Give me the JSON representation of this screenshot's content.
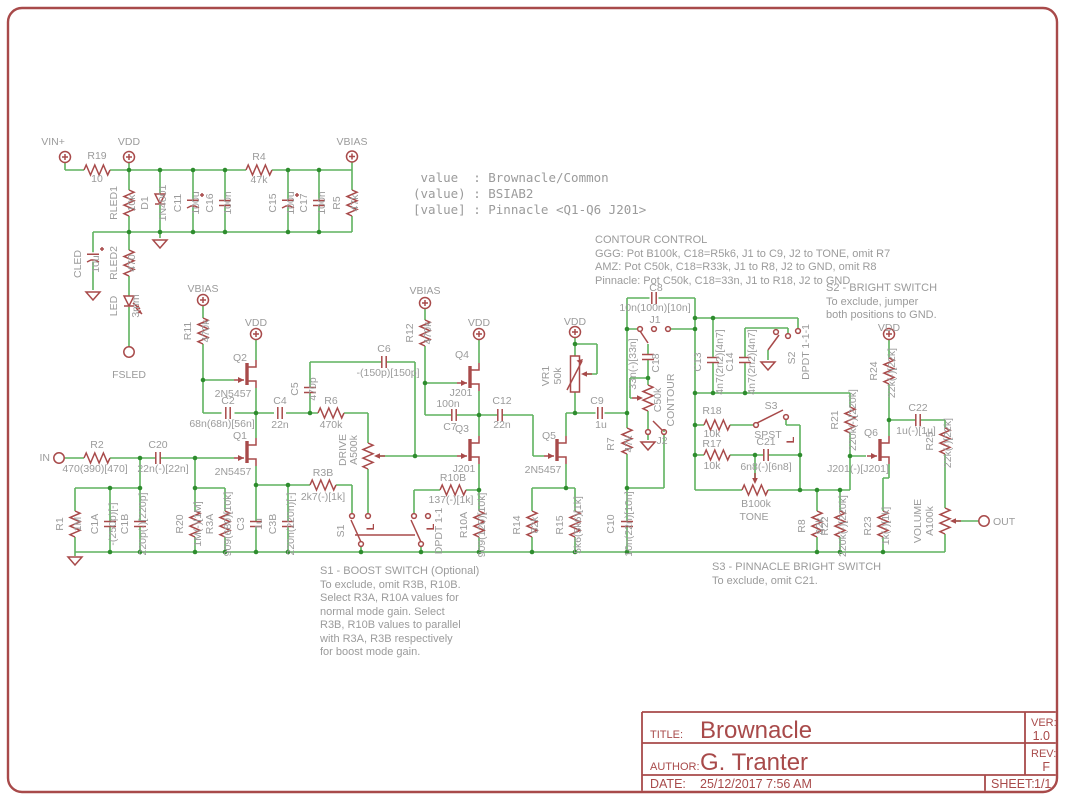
{
  "page": {
    "bg": "#ffffff",
    "frame_color": "#a84a4a",
    "wire_color": "#5fb25f",
    "junction_color": "#2e8c2e",
    "symbol_color": "#a84a4a",
    "label_color": "#9b9b9b"
  },
  "value_block": {
    "lines": [
      " value  : Brownacle/Common",
      "(value) : BSIAB2",
      "[value] : Pinnacle <Q1-Q6 J201>"
    ]
  },
  "notes": {
    "contour": {
      "lines": [
        "CONTOUR CONTROL",
        "GGG: Pot B100k, C18=R5k6, J1 to C9, J2 to TONE, omit R7",
        "AMZ: Pot C50k, C18=R33k, J1 to R8, J2 to GND, omit R8",
        "Pinnacle: Pot C50k, C18=33n, J1 to R18, J2 to GND"
      ]
    },
    "s2": {
      "lines": [
        "S2 - BRIGHT SWITCH",
        "To exclude, jumper",
        "both positions to GND."
      ]
    },
    "s1": {
      "lines": [
        "S1 - BOOST SWITCH (Optional)",
        "To exclude, omit R3B, R10B.",
        "Select R3A, R10A values for",
        "normal mode gain. Select",
        "R3B, R10B values to parallel",
        "with R3A, R3B respectively",
        "for boost mode gain."
      ]
    },
    "s3": {
      "lines": [
        "S3 - PINNACLE BRIGHT SWITCH",
        "To exclude, omit C21."
      ]
    }
  },
  "title_block": {
    "title_label": "TITLE:",
    "title": "Brownacle",
    "author_label": "AUTHOR:",
    "author": "G. Tranter",
    "date_label": "DATE:",
    "date": "25/12/2017 7:56 AM",
    "ver_label": "VER:",
    "ver": "1.0",
    "rev_label": "REV:",
    "rev": "F",
    "sheet_label": "SHEET:",
    "sheet": "1/1"
  },
  "labels": [
    {
      "t": "VIN+",
      "x": 53,
      "y": 145
    },
    {
      "t": "R19",
      "x": 97,
      "y": 159
    },
    {
      "t": "10",
      "x": 97,
      "y": 182
    },
    {
      "t": "VDD",
      "x": 129,
      "y": 145
    },
    {
      "t": "VBIAS",
      "x": 352,
      "y": 145
    },
    {
      "t": "RLED1",
      "x": 117,
      "y": 203,
      "r": 1
    },
    {
      "t": "10k",
      "x": 135,
      "y": 203,
      "r": 1
    },
    {
      "t": "D1",
      "x": 148,
      "y": 203,
      "r": 1
    },
    {
      "t": "1N4001",
      "x": 166,
      "y": 203,
      "r": 1
    },
    {
      "t": "C11",
      "x": 181,
      "y": 203,
      "r": 1
    },
    {
      "t": "100u",
      "x": 199,
      "y": 203,
      "r": 1
    },
    {
      "t": "C16",
      "x": 213,
      "y": 203,
      "r": 1
    },
    {
      "t": "100n",
      "x": 231,
      "y": 203,
      "r": 1
    },
    {
      "t": "R4",
      "x": 259,
      "y": 160
    },
    {
      "t": "47k",
      "x": 259,
      "y": 183
    },
    {
      "t": "C15",
      "x": 276,
      "y": 203,
      "r": 1
    },
    {
      "t": "100u",
      "x": 294,
      "y": 203,
      "r": 1
    },
    {
      "t": "C17",
      "x": 307,
      "y": 203,
      "r": 1
    },
    {
      "t": "100n",
      "x": 325,
      "y": 203,
      "r": 1
    },
    {
      "t": "R5",
      "x": 340,
      "y": 203,
      "r": 1
    },
    {
      "t": "47k",
      "x": 358,
      "y": 203,
      "r": 1
    },
    {
      "t": "CLED",
      "x": 81,
      "y": 264,
      "r": 1
    },
    {
      "t": "10u",
      "x": 99,
      "y": 264,
      "r": 1
    },
    {
      "t": "RLED2",
      "x": 117,
      "y": 263,
      "r": 1
    },
    {
      "t": "470",
      "x": 135,
      "y": 263,
      "r": 1
    },
    {
      "t": "LED",
      "x": 117,
      "y": 306,
      "r": 1
    },
    {
      "t": "3mm",
      "x": 139,
      "y": 306,
      "r": 1
    },
    {
      "t": "FSLED",
      "x": 129,
      "y": 378
    },
    {
      "t": "VBIAS",
      "x": 203,
      "y": 292
    },
    {
      "t": "R11",
      "x": 191,
      "y": 331,
      "r": 1
    },
    {
      "t": "470k",
      "x": 209,
      "y": 331,
      "r": 1
    },
    {
      "t": "VDD",
      "x": 256,
      "y": 326
    },
    {
      "t": "Q2",
      "x": 240,
      "y": 361
    },
    {
      "t": "2N5457",
      "x": 233,
      "y": 397
    },
    {
      "t": "C2",
      "x": 228,
      "y": 404
    },
    {
      "t": "68n(68n)[56n]",
      "x": 222,
      "y": 427
    },
    {
      "t": "Q1",
      "x": 240,
      "y": 439
    },
    {
      "t": "2N5457",
      "x": 233,
      "y": 475
    },
    {
      "t": "IN",
      "x": 50,
      "y": 461,
      "a": "e"
    },
    {
      "t": "R2",
      "x": 97,
      "y": 448
    },
    {
      "t": "470(390)[470]",
      "x": 95,
      "y": 472
    },
    {
      "t": "C20",
      "x": 158,
      "y": 448
    },
    {
      "t": "22n(-)[22n]",
      "x": 163,
      "y": 472
    },
    {
      "t": "R1",
      "x": 63,
      "y": 524,
      "r": 1
    },
    {
      "t": "1M",
      "x": 81,
      "y": 524,
      "r": 1
    },
    {
      "t": "C1A",
      "x": 98,
      "y": 524,
      "r": 1
    },
    {
      "t": "-(250p)[-]",
      "x": 116,
      "y": 524,
      "r": 1
    },
    {
      "t": "C1B",
      "x": 128,
      "y": 524,
      "r": 1
    },
    {
      "t": "220p(-)[220p]",
      "x": 146,
      "y": 524,
      "r": 1
    },
    {
      "t": "R20",
      "x": 183,
      "y": 524,
      "r": 1
    },
    {
      "t": "1M(-)[1M]",
      "x": 201,
      "y": 524,
      "r": 1
    },
    {
      "t": "R3A",
      "x": 213,
      "y": 524,
      "r": 1
    },
    {
      "t": "909(680)[10k]",
      "x": 231,
      "y": 524,
      "r": 1
    },
    {
      "t": "C3",
      "x": 244,
      "y": 524,
      "r": 1
    },
    {
      "t": "1u",
      "x": 262,
      "y": 524,
      "r": 1
    },
    {
      "t": "C3B",
      "x": 276,
      "y": 524,
      "r": 1
    },
    {
      "t": "220n(220n)[-]",
      "x": 294,
      "y": 524,
      "r": 1
    },
    {
      "t": "C4",
      "x": 280,
      "y": 404
    },
    {
      "t": "22n",
      "x": 280,
      "y": 428
    },
    {
      "t": "C5",
      "x": 298,
      "y": 389,
      "r": 1
    },
    {
      "t": "470p",
      "x": 316,
      "y": 389,
      "r": 1
    },
    {
      "t": "R6",
      "x": 331,
      "y": 404
    },
    {
      "t": "470k",
      "x": 331,
      "y": 428
    },
    {
      "t": "C6",
      "x": 384,
      "y": 352
    },
    {
      "t": "-(150p)[150p]",
      "x": 388,
      "y": 376
    },
    {
      "t": "DRIVE",
      "x": 346,
      "y": 450,
      "r": 1
    },
    {
      "t": "A500k",
      "x": 357,
      "y": 450,
      "r": 1
    },
    {
      "t": "R3B",
      "x": 323,
      "y": 476
    },
    {
      "t": "2k7(-)[1k]",
      "x": 323,
      "y": 500
    },
    {
      "t": "S1",
      "x": 344,
      "y": 531,
      "r": 1
    },
    {
      "t": "DPDT 1-1",
      "x": 442,
      "y": 531,
      "r": 1
    },
    {
      "t": "L",
      "x": 374,
      "y": 527,
      "r": 1,
      "c": "r"
    },
    {
      "t": "L",
      "x": 434,
      "y": 527,
      "r": 1,
      "c": "r"
    },
    {
      "t": "VBIAS",
      "x": 425,
      "y": 294
    },
    {
      "t": "R12",
      "x": 413,
      "y": 333,
      "r": 1
    },
    {
      "t": "470k",
      "x": 431,
      "y": 333,
      "r": 1
    },
    {
      "t": "VDD",
      "x": 479,
      "y": 326
    },
    {
      "t": "Q4",
      "x": 462,
      "y": 358
    },
    {
      "t": "J201",
      "x": 461,
      "y": 396
    },
    {
      "t": "100n",
      "x": 448,
      "y": 407
    },
    {
      "t": "C7",
      "x": 450,
      "y": 430
    },
    {
      "t": "Q3",
      "x": 462,
      "y": 432
    },
    {
      "t": "J201",
      "x": 464,
      "y": 472
    },
    {
      "t": "R10B",
      "x": 453,
      "y": 481
    },
    {
      "t": "137(-)[1k]",
      "x": 451,
      "y": 503
    },
    {
      "t": "R10A",
      "x": 467,
      "y": 525,
      "r": 1
    },
    {
      "t": "909(120)[10k]",
      "x": 485,
      "y": 525,
      "r": 1
    },
    {
      "t": "R14",
      "x": 520,
      "y": 525,
      "r": 1
    },
    {
      "t": "82k",
      "x": 538,
      "y": 525,
      "r": 1
    },
    {
      "t": "R15",
      "x": 563,
      "y": 525,
      "r": 1
    },
    {
      "t": "5k6(5k6)[1k]",
      "x": 581,
      "y": 525,
      "r": 1
    },
    {
      "t": "C12",
      "x": 502,
      "y": 404
    },
    {
      "t": "22n",
      "x": 502,
      "y": 428
    },
    {
      "t": "VDD",
      "x": 575,
      "y": 325
    },
    {
      "t": "VR1",
      "x": 549,
      "y": 376,
      "r": 1
    },
    {
      "t": "50k",
      "x": 561,
      "y": 376,
      "r": 1
    },
    {
      "t": "Q5",
      "x": 549,
      "y": 439
    },
    {
      "t": "2N5457",
      "x": 543,
      "y": 473
    },
    {
      "t": "C9",
      "x": 597,
      "y": 404
    },
    {
      "t": "1u",
      "x": 601,
      "y": 428
    },
    {
      "t": "R7",
      "x": 614,
      "y": 444,
      "r": 1
    },
    {
      "t": "47k",
      "x": 632,
      "y": 444,
      "r": 1
    },
    {
      "t": "C10",
      "x": 614,
      "y": 524,
      "r": 1
    },
    {
      "t": "10n(22n)[10n]",
      "x": 632,
      "y": 524,
      "r": 1
    },
    {
      "t": "C8",
      "x": 656,
      "y": 291
    },
    {
      "t": "10n(100n)[10n]",
      "x": 655,
      "y": 311
    },
    {
      "t": "J1",
      "x": 655,
      "y": 323
    },
    {
      "t": "33n(-)[33n]",
      "x": 636,
      "y": 364,
      "r": 1
    },
    {
      "t": "C18",
      "x": 659,
      "y": 363,
      "r": 1
    },
    {
      "t": "C50k",
      "x": 661,
      "y": 400,
      "r": 1
    },
    {
      "t": "CONTOUR",
      "x": 674,
      "y": 400,
      "r": 1
    },
    {
      "t": "J2",
      "x": 662,
      "y": 444
    },
    {
      "t": "C13",
      "x": 701,
      "y": 362,
      "r": 1
    },
    {
      "t": "4n7(2n2)[4n7]",
      "x": 723,
      "y": 362,
      "r": 1
    },
    {
      "t": "C14",
      "x": 733,
      "y": 362,
      "r": 1
    },
    {
      "t": "4n7(2n2)[4n7]",
      "x": 755,
      "y": 362,
      "r": 1
    },
    {
      "t": "S2",
      "x": 795,
      "y": 358,
      "r": 1
    },
    {
      "t": "DPDT 1-1-1",
      "x": 809,
      "y": 352,
      "r": 1
    },
    {
      "t": "R18",
      "x": 712,
      "y": 414
    },
    {
      "t": "10k",
      "x": 712,
      "y": 437
    },
    {
      "t": "R17",
      "x": 712,
      "y": 447
    },
    {
      "t": "10k",
      "x": 712,
      "y": 469
    },
    {
      "t": "S3",
      "x": 771,
      "y": 409
    },
    {
      "t": "SPST",
      "x": 768,
      "y": 438
    },
    {
      "t": "L",
      "x": 794,
      "y": 440,
      "r": 1,
      "c": "r"
    },
    {
      "t": "C21",
      "x": 766,
      "y": 445
    },
    {
      "t": "6n8(-)[6n8]",
      "x": 766,
      "y": 470
    },
    {
      "t": "B100k",
      "x": 756,
      "y": 507
    },
    {
      "t": "TONE",
      "x": 754,
      "y": 520
    },
    {
      "t": "R21",
      "x": 838,
      "y": 420,
      "r": 1
    },
    {
      "t": "220k(-)[220k]",
      "x": 856,
      "y": 420,
      "r": 1
    },
    {
      "t": "VDD",
      "x": 889,
      "y": 331
    },
    {
      "t": "R24",
      "x": 877,
      "y": 371,
      "r": 1
    },
    {
      "t": "22k(-)[22k]",
      "x": 895,
      "y": 373,
      "r": 1
    },
    {
      "t": "C22",
      "x": 918,
      "y": 411
    },
    {
      "t": "1u(-)[1u]",
      "x": 916,
      "y": 434
    },
    {
      "t": "Q6",
      "x": 871,
      "y": 436
    },
    {
      "t": "J201(-)[J201]",
      "x": 858,
      "y": 472
    },
    {
      "t": "R25",
      "x": 933,
      "y": 441,
      "r": 1
    },
    {
      "t": "22k(-)[22k]",
      "x": 951,
      "y": 443,
      "r": 1
    },
    {
      "t": "R8",
      "x": 805,
      "y": 526,
      "r": 1
    },
    {
      "t": "82k",
      "x": 823,
      "y": 526,
      "r": 1
    },
    {
      "t": "R22",
      "x": 828,
      "y": 526,
      "r": 1
    },
    {
      "t": "220k(-)[220k]",
      "x": 846,
      "y": 526,
      "r": 1
    },
    {
      "t": "R23",
      "x": 871,
      "y": 526,
      "r": 1
    },
    {
      "t": "1k(-)[1k]",
      "x": 889,
      "y": 526,
      "r": 1
    },
    {
      "t": "VOLUME",
      "x": 921,
      "y": 521,
      "r": 1
    },
    {
      "t": "A100k",
      "x": 933,
      "y": 521,
      "r": 1
    },
    {
      "t": "OUT",
      "x": 993,
      "y": 525,
      "a": "s"
    }
  ]
}
